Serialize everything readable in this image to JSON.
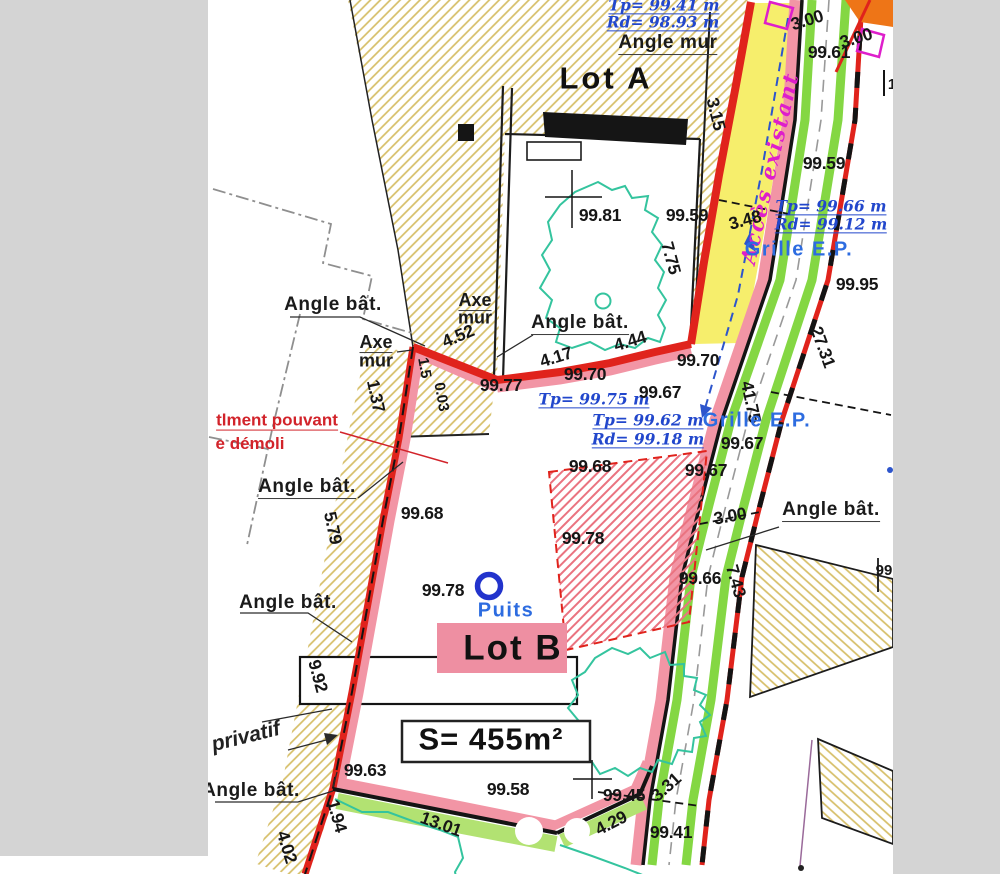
{
  "title": "Plan de division - Lot B",
  "colors": {
    "red": "#e0231c",
    "pink": "#f295a5",
    "pinkbox": "#ee8fa2",
    "yellow": "#f6ee6c",
    "green": "#84d743",
    "green_soft": "#b2e272",
    "teal": "#34c49e",
    "blue": "#2247cc",
    "blue2": "#2d6ce0",
    "magenta": "#de1ecb",
    "orange": "#ee7517",
    "hatch_tan": "#d6be67",
    "hatch_red": "#ea7380",
    "red_text": "#d2232a",
    "gray_bar": "#d4d4d4",
    "gray_dash": "#8f8f8f"
  },
  "surface_label": "S= 455m²",
  "lots": [
    "Lot A",
    "Lot B"
  ],
  "labels": [
    {
      "t": "Tp= 99.41 m",
      "x": 664,
      "y": 6,
      "r": 0,
      "c": "b"
    },
    {
      "t": "Rd= 98.93 m",
      "x": 663,
      "y": 23,
      "r": 0,
      "c": "b"
    },
    {
      "t": "Angle  mur",
      "x": 668,
      "y": 44,
      "r": 0,
      "c": "au"
    },
    {
      "t": "Lot A",
      "x": 606,
      "y": 79,
      "r": 0,
      "c": "lot"
    },
    {
      "t": "3.15",
      "x": 716,
      "y": 114,
      "r": 76,
      "c": "m"
    },
    {
      "t": "3.00",
      "x": 807,
      "y": 20,
      "r": -17,
      "c": "m"
    },
    {
      "t": "3.00",
      "x": 856,
      "y": 38,
      "r": -17,
      "c": "m"
    },
    {
      "t": "99.61",
      "x": 829,
      "y": 52,
      "r": 0,
      "c": "m"
    },
    {
      "t": "Accès existant",
      "x": 770,
      "y": 168,
      "r": -77,
      "c": "mag"
    },
    {
      "t": "99.59",
      "x": 824,
      "y": 163,
      "r": 0,
      "c": "m"
    },
    {
      "t": "Tp= 99.66 m",
      "x": 831,
      "y": 207,
      "r": 0,
      "c": "b"
    },
    {
      "t": "Rd= 99.12 m",
      "x": 831,
      "y": 225,
      "r": 0,
      "c": "b"
    },
    {
      "t": "Grille  E.P.",
      "x": 799,
      "y": 250,
      "r": 0,
      "c": "g"
    },
    {
      "t": "3.48",
      "x": 745,
      "y": 220,
      "r": -15,
      "c": "m"
    },
    {
      "t": "99.95",
      "x": 857,
      "y": 284,
      "r": 0,
      "c": "m"
    },
    {
      "t": "99.81",
      "x": 600,
      "y": 215,
      "r": 0,
      "c": "m"
    },
    {
      "t": "99.59",
      "x": 687,
      "y": 215,
      "r": 0,
      "c": "m"
    },
    {
      "t": "7.75",
      "x": 671,
      "y": 258,
      "r": 75,
      "c": "m"
    },
    {
      "t": "27.31",
      "x": 823,
      "y": 347,
      "r": 70,
      "c": "m"
    },
    {
      "t": "Angle  bât.",
      "x": 333,
      "y": 305,
      "r": 0,
      "c": "a"
    },
    {
      "t": "Angle  bât.",
      "x": 580,
      "y": 324,
      "r": 0,
      "c": "au"
    },
    {
      "t": "Axe",
      "x": 475,
      "y": 301,
      "r": 0,
      "c": "axu"
    },
    {
      "t": "mur",
      "x": 475,
      "y": 318,
      "r": 0,
      "c": "ax"
    },
    {
      "t": "Axe",
      "x": 376,
      "y": 343,
      "r": 0,
      "c": "axu"
    },
    {
      "t": "mur",
      "x": 376,
      "y": 361,
      "r": 0,
      "c": "ax"
    },
    {
      "t": "4.52",
      "x": 458,
      "y": 336,
      "r": -23,
      "c": "m"
    },
    {
      "t": "4.44",
      "x": 630,
      "y": 341,
      "r": -17,
      "c": "m"
    },
    {
      "t": "4.17",
      "x": 556,
      "y": 357,
      "r": -17,
      "c": "m"
    },
    {
      "t": "99.70",
      "x": 585,
      "y": 374,
      "r": 0,
      "c": "m"
    },
    {
      "t": "99.70",
      "x": 698,
      "y": 360,
      "r": 0,
      "c": "m"
    },
    {
      "t": "41.75",
      "x": 751,
      "y": 402,
      "r": 78,
      "c": "m"
    },
    {
      "t": "1.37",
      "x": 376,
      "y": 396,
      "r": 78,
      "c": "m"
    },
    {
      "t": "1.5",
      "x": 424,
      "y": 368,
      "r": 80,
      "c": "ms"
    },
    {
      "t": "0.03",
      "x": 441,
      "y": 397,
      "r": 80,
      "c": "ms"
    },
    {
      "t": "99.77",
      "x": 501,
      "y": 385,
      "r": 0,
      "c": "m"
    },
    {
      "t": "Tp= 99.75 m",
      "x": 594,
      "y": 400,
      "r": 0,
      "c": "b"
    },
    {
      "t": "99.67",
      "x": 660,
      "y": 392,
      "r": 0,
      "c": "m"
    },
    {
      "t": "Tp= 99.62 m",
      "x": 648,
      "y": 421,
      "r": 0,
      "c": "b"
    },
    {
      "t": "Rd= 99.18 m",
      "x": 648,
      "y": 440,
      "r": 0,
      "c": "b"
    },
    {
      "t": "Grille  E.P.",
      "x": 757,
      "y": 421,
      "r": 0,
      "c": "g"
    },
    {
      "t": "99.67",
      "x": 742,
      "y": 443,
      "r": 0,
      "c": "m"
    },
    {
      "t": "99.67",
      "x": 706,
      "y": 470,
      "r": 0,
      "c": "m"
    },
    {
      "t": "99.68",
      "x": 590,
      "y": 466,
      "r": 0,
      "c": "m"
    },
    {
      "t": "tlment pouvant",
      "x": 277,
      "y": 421,
      "r": 0,
      "c": "redu"
    },
    {
      "t": "e démoli",
      "x": 250,
      "y": 444,
      "r": 0,
      "c": "red"
    },
    {
      "t": "Angle  bât.",
      "x": 307,
      "y": 488,
      "r": 0,
      "c": "au"
    },
    {
      "t": "99.68",
      "x": 422,
      "y": 513,
      "r": 0,
      "c": "m"
    },
    {
      "t": "Angle  bât.",
      "x": 831,
      "y": 511,
      "r": 0,
      "c": "au"
    },
    {
      "t": "3.00",
      "x": 730,
      "y": 516,
      "r": -10,
      "c": "m"
    },
    {
      "t": "99.78",
      "x": 583,
      "y": 538,
      "r": 0,
      "c": "m"
    },
    {
      "t": "5.79",
      "x": 333,
      "y": 528,
      "r": 78,
      "c": "m"
    },
    {
      "t": "7.43",
      "x": 736,
      "y": 581,
      "r": 74,
      "c": "m"
    },
    {
      "t": "99.66",
      "x": 700,
      "y": 578,
      "r": 0,
      "c": "m"
    },
    {
      "t": "99",
      "x": 884,
      "y": 571,
      "r": 0,
      "c": "ms"
    },
    {
      "t": "Angle  bât.",
      "x": 288,
      "y": 603,
      "r": 0,
      "c": "a"
    },
    {
      "t": "99.78",
      "x": 443,
      "y": 590,
      "r": 0,
      "c": "m"
    },
    {
      "t": "Puits",
      "x": 506,
      "y": 611,
      "r": 0,
      "c": "g"
    },
    {
      "t": "Lot B",
      "x": 513,
      "y": 649,
      "r": 0,
      "c": "lot2"
    },
    {
      "t": "9.92",
      "x": 318,
      "y": 676,
      "r": 75,
      "c": "m"
    },
    {
      "t": "S= 455m²",
      "x": 491,
      "y": 740,
      "r": 0,
      "c": "s"
    },
    {
      "t": "privatif",
      "x": 246,
      "y": 737,
      "r": -14,
      "c": "priv"
    },
    {
      "t": "Angle  bât.",
      "x": 251,
      "y": 791,
      "r": 0,
      "c": "a"
    },
    {
      "t": "99.63",
      "x": 365,
      "y": 770,
      "r": 0,
      "c": "m"
    },
    {
      "t": "99.58",
      "x": 508,
      "y": 789,
      "r": 0,
      "c": "m"
    },
    {
      "t": "99.45",
      "x": 624,
      "y": 795,
      "r": 0,
      "c": "m"
    },
    {
      "t": "3.31",
      "x": 666,
      "y": 787,
      "r": -42,
      "c": "m"
    },
    {
      "t": "13.01",
      "x": 441,
      "y": 824,
      "r": 20,
      "c": "m"
    },
    {
      "t": "1.94",
      "x": 337,
      "y": 816,
      "r": 74,
      "c": "m"
    },
    {
      "t": "4.29",
      "x": 611,
      "y": 823,
      "r": -27,
      "c": "m"
    },
    {
      "t": "99.41",
      "x": 671,
      "y": 832,
      "r": 0,
      "c": "m"
    },
    {
      "t": "4.02",
      "x": 287,
      "y": 847,
      "r": 73,
      "c": "m"
    },
    {
      "t": "1",
      "x": 892,
      "y": 85,
      "r": 0,
      "c": "ms"
    }
  ]
}
